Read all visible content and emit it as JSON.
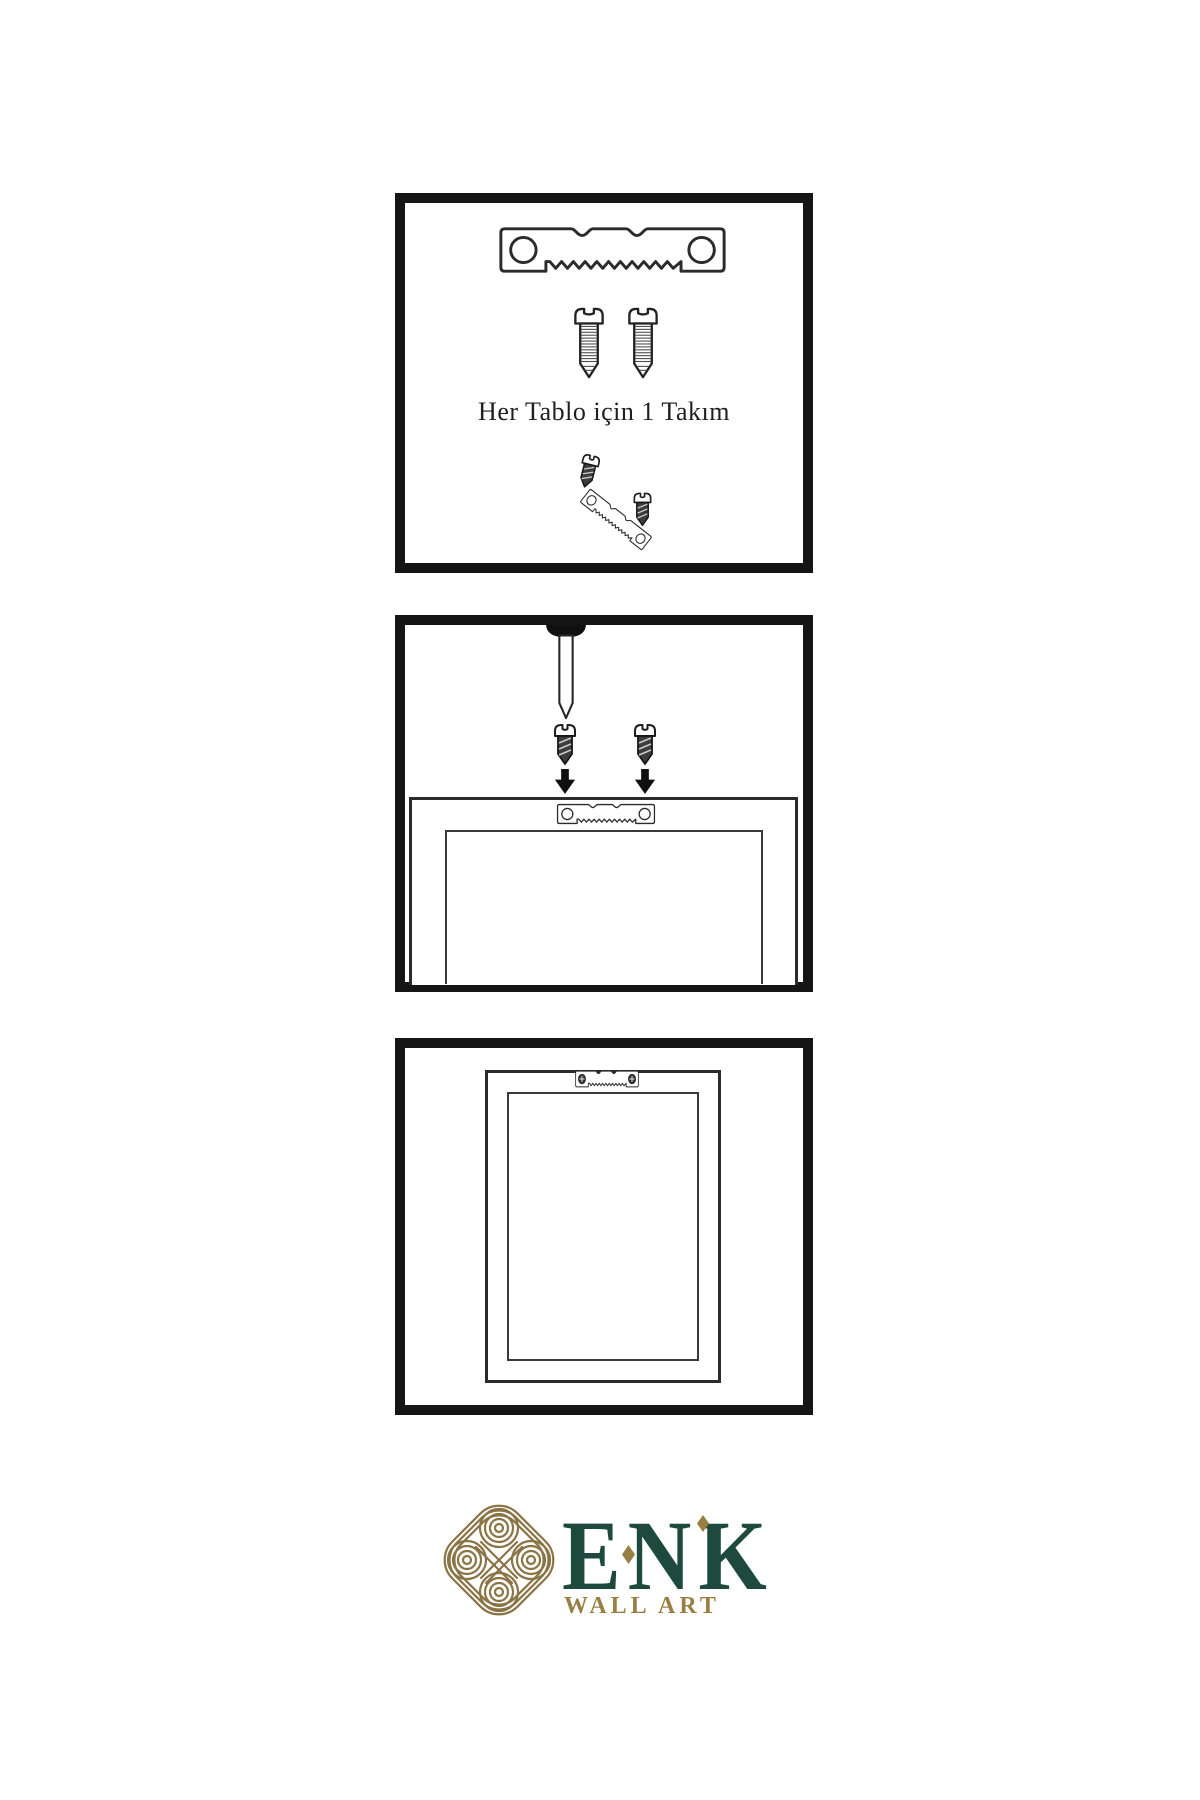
{
  "page": {
    "background": "#ffffff"
  },
  "colors": {
    "panel_border": "#151515",
    "line_art": "#2b2b2b",
    "screw_dark_fill": "#3c3c3c",
    "logo_gold": "#9a7f45",
    "logo_green": "#1d4a3c"
  },
  "panels": {
    "kit": {
      "caption": "Her Tablo için 1 Takım",
      "icons": [
        "sawtooth-hanger-icon",
        "screw-icon",
        "screw-icon",
        "screw-dark-icon",
        "sawtooth-hanger-tilted-icon",
        "screw-dark-icon"
      ]
    },
    "mounting": {
      "icons": [
        "nail-in-wall-icon",
        "screw-dark-icon",
        "screw-dark-icon",
        "arrow-down-icon",
        "arrow-down-icon",
        "frame-back-icon",
        "sawtooth-hanger-icon"
      ]
    },
    "hung": {
      "icons": [
        "frame-back-icon",
        "sawtooth-hanger-screwed-icon"
      ]
    }
  },
  "logo": {
    "brand": "ENK",
    "tagline": "WALL ART",
    "symbol": "knot-icon"
  }
}
